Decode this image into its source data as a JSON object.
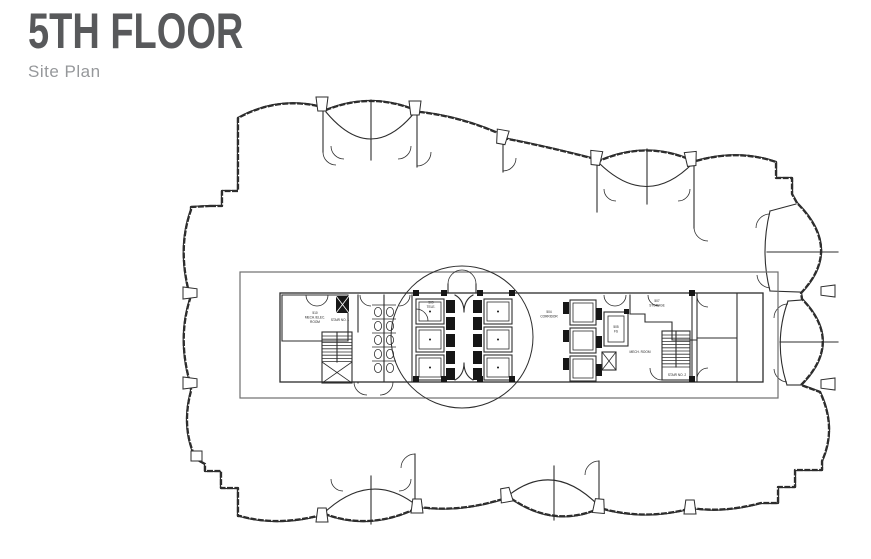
{
  "header": {
    "title": "5TH FLOOR",
    "subtitle": "Site Plan"
  },
  "colors": {
    "title_gray": "#58595b",
    "subtitle_gray": "#96989b",
    "line": "#2d2d2d"
  },
  "plan": {
    "labels": {
      "room_510": [
        "510",
        "MECH./ELEC.",
        "ROOM"
      ],
      "room_509": [
        "509",
        "TELE."
      ],
      "corridor_504": [
        "504",
        "CORRIDOR"
      ],
      "room_505": [
        "505",
        "FS"
      ],
      "mech_room": [
        "MECH. ROOM"
      ],
      "room_507": [
        "507",
        "STORAGE"
      ],
      "stair_1": [
        "STAIR NO. 1"
      ],
      "stair_2": [
        "STAIR NO. 2"
      ]
    }
  }
}
